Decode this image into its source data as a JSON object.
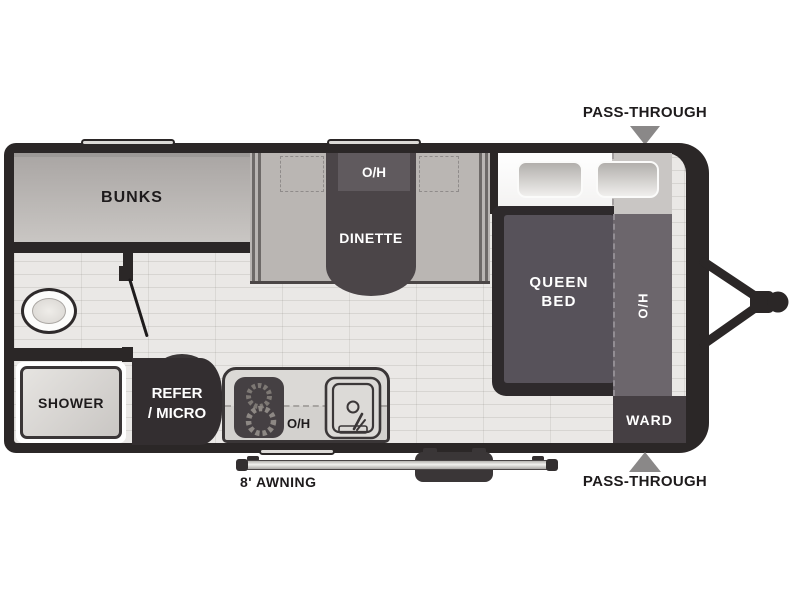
{
  "floorplan": {
    "title": "travel trailer floor plan",
    "labels": {
      "bunks": "BUNKS",
      "dinette_overhead": "O/H",
      "dinette": "DINETTE",
      "queen_bed_line1": "QUEEN",
      "queen_bed_line2": "BED",
      "bed_overhead": "O/H",
      "wardrobe": "WARD",
      "shower": "SHOWER",
      "refrigerator_line1": "REFER",
      "refrigerator_line2": "/ MICRO",
      "kitchen_overhead": "O/H",
      "awning": "8' AWNING",
      "pass_through_top": "PASS-THROUGH",
      "pass_through_bottom": "PASS-THROUGH"
    },
    "colors": {
      "wall": "#2b2727",
      "furniture_dark": "#4b4548",
      "bed_fill": "#57525a",
      "overhead_strip": "#6c666c",
      "wardrobe_fill": "#453f43",
      "refrigerator_fill": "#332e30",
      "bench": "#bab6b3",
      "floor": "#eae8e6",
      "arrow_gray": "#8a8888"
    }
  }
}
